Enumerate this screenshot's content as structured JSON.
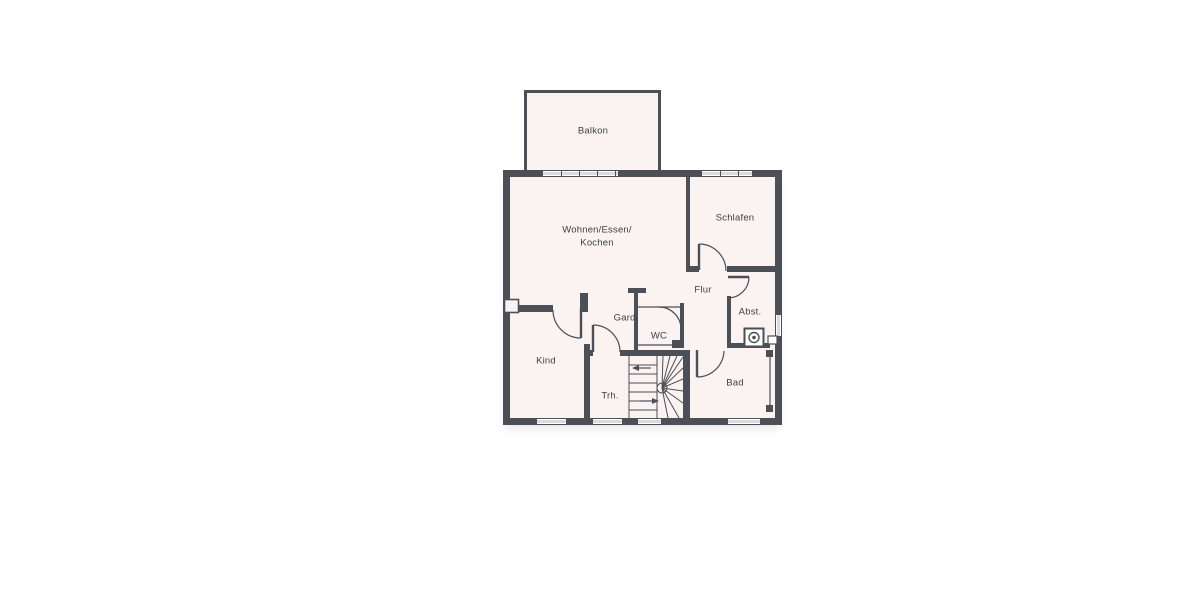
{
  "floorplan": {
    "rooms": {
      "balkon": "Balkon",
      "wohnen_line1": "Wohnen/Essen/",
      "wohnen_line2": "Kochen",
      "schlafen": "Schlafen",
      "flur": "Flur",
      "gard": "Gard.",
      "wc": "WC",
      "abst": "Abst.",
      "kind": "Kind",
      "trh": "Trh.",
      "bad": "Bad"
    },
    "colors": {
      "wall": "#4c4f55",
      "floor": "#faf3f2",
      "window_glass": "#d9dbdd",
      "background": "#ffffff",
      "text": "#3c3f44"
    },
    "icons": {
      "washing_machine": "washing-machine-icon",
      "stair_arrow_left": "stair-arrow-left-icon",
      "stair_arrow_right": "stair-arrow-right-icon"
    }
  }
}
